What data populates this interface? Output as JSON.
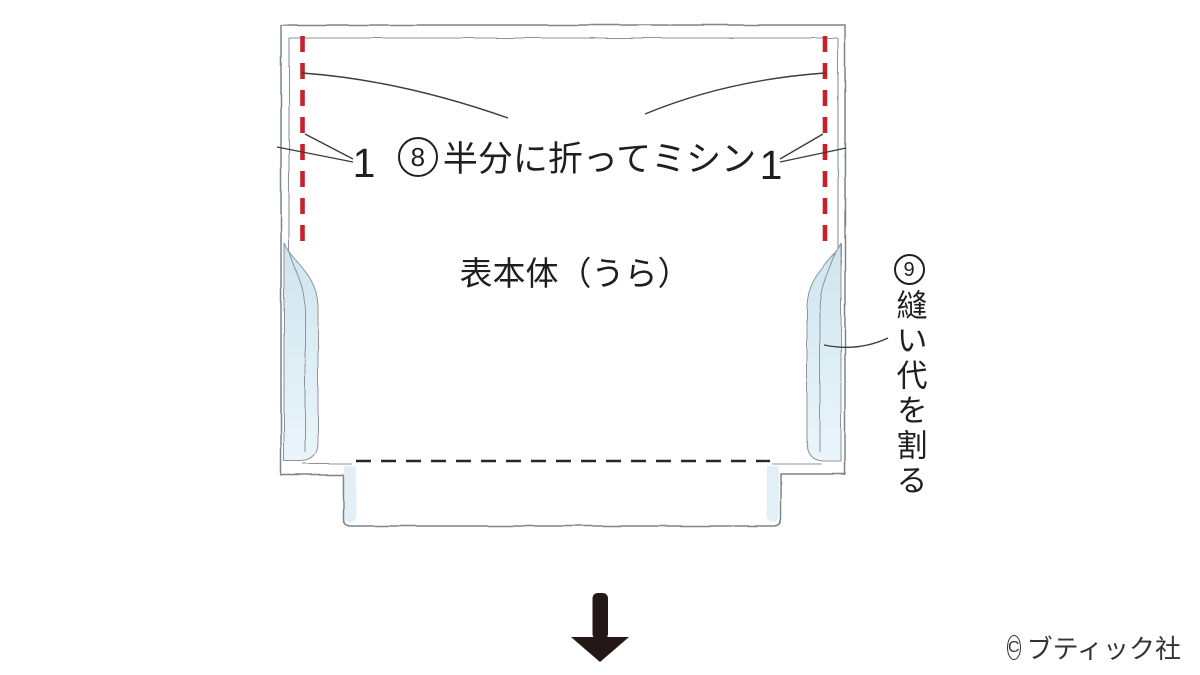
{
  "diagram": {
    "title_note": "sewing-step-diagram",
    "labels": {
      "step8_num": "8",
      "step8_text": "半分に折ってミシン",
      "piece_name": "表本体（うら）",
      "step9_num": "9",
      "step9_text": "縫い代を割る",
      "seam_width_left": "1",
      "seam_width_right": "1"
    },
    "copyright": {
      "mark": "C",
      "text": "ブティック社"
    },
    "colors": {
      "stitch_red": "#c4232b",
      "outline_gray": "#7d858a",
      "inner_gray": "#8d959a",
      "fabric_blue": "#cfe5ef",
      "fabric_blue_light": "#eaf5fa",
      "slot_blue": "#e2eff6",
      "fold_dash_black": "#272727",
      "leader_gray": "#3c3c3c",
      "arrow_black": "#231815"
    }
  }
}
